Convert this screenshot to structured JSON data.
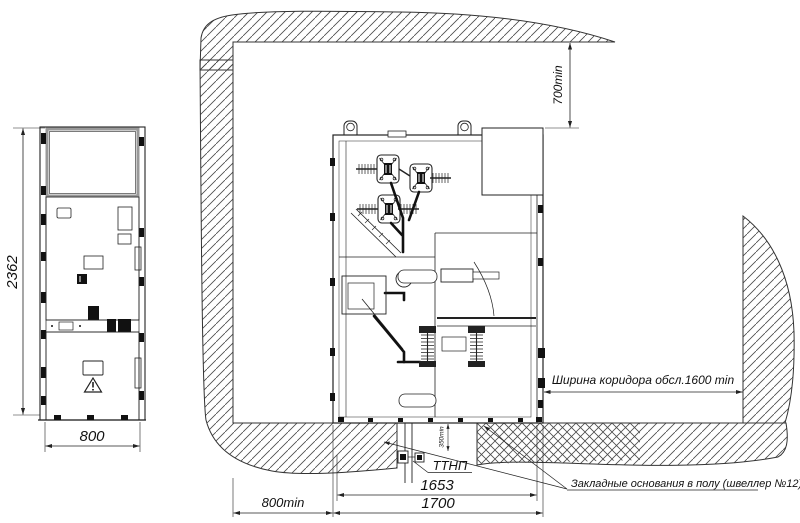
{
  "drawing": {
    "type": "switchgear-installation-drawing",
    "front": {
      "height": "2362",
      "width": "800"
    },
    "plan": {
      "rear_clearance": "700min",
      "front_clearance": "800min",
      "corridor": "Ширина коридора обсл.1600 min",
      "trench_depth": "350min",
      "ttnp": "ТТНП",
      "dim_foundation": "1653",
      "dim_overall": "1700",
      "foundation_note": "Закладные основания в полу (швеллер №12)"
    },
    "colors": {
      "line": "#222222",
      "hatch": "#444444",
      "background": "#ffffff"
    }
  }
}
